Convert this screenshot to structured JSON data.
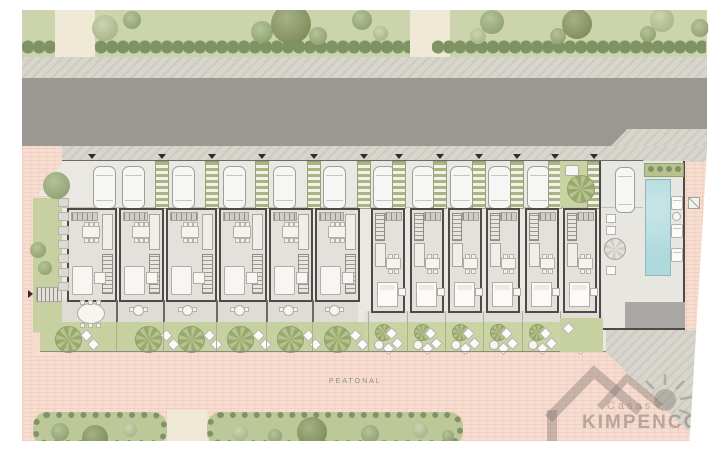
{
  "title": "Residential development site plan",
  "labels": {
    "promenade": "PEATONAL"
  },
  "watermark": {
    "line1": "Casas",
    "line2": "KIMPENCO"
  },
  "colors": {
    "park_green": "#ccd4ad",
    "hedge": "#7e9264",
    "path_cream": "#f0e9d6",
    "sidewalk": "#d8d5cd",
    "road": "#9b9892",
    "promenade_pink": "#f7dcd0",
    "site_paving": "#e9e8e3",
    "wall": "#4c4b47",
    "garden_green": "#c6d0a0",
    "pergola_stripe": "#a9b482",
    "pool_blue": "#aed9dd",
    "tree_light": "#b9c795",
    "tree_mid": "#9cb077",
    "tree_dark": "#87975c",
    "logo_gray": "rgba(128,118,111,0.45)"
  },
  "park_top": {
    "paths_x": [
      55,
      410
    ],
    "trees": [
      {
        "x": 105,
        "y": 28,
        "d": 26,
        "t": "light"
      },
      {
        "x": 132,
        "y": 20,
        "d": 18,
        "t": "mid"
      },
      {
        "x": 262,
        "y": 32,
        "d": 22,
        "t": "mid"
      },
      {
        "x": 291,
        "y": 24,
        "d": 40,
        "t": "dark"
      },
      {
        "x": 318,
        "y": 36,
        "d": 18,
        "t": "mid"
      },
      {
        "x": 362,
        "y": 20,
        "d": 20,
        "t": "mid"
      },
      {
        "x": 380,
        "y": 33,
        "d": 15,
        "t": "light"
      },
      {
        "x": 478,
        "y": 36,
        "d": 16,
        "t": "light"
      },
      {
        "x": 492,
        "y": 22,
        "d": 24,
        "t": "mid"
      },
      {
        "x": 558,
        "y": 36,
        "d": 16,
        "t": "mid"
      },
      {
        "x": 577,
        "y": 24,
        "d": 30,
        "t": "dark"
      },
      {
        "x": 648,
        "y": 34,
        "d": 16,
        "t": "mid"
      },
      {
        "x": 662,
        "y": 20,
        "d": 24,
        "t": "light"
      },
      {
        "x": 700,
        "y": 28,
        "d": 18,
        "t": "mid"
      }
    ],
    "hedge_segments": [
      {
        "x": 22,
        "w": 33
      },
      {
        "x": 95,
        "w": 315
      },
      {
        "x": 432,
        "w": 274
      }
    ]
  },
  "parking": {
    "cars_x": [
      93,
      122,
      172,
      223,
      273,
      323,
      373,
      412,
      450,
      488,
      527
    ],
    "separators_x": [
      155,
      205,
      255,
      307,
      357,
      392,
      433,
      472,
      510,
      548,
      587
    ],
    "lead_arrow_x": 88
  },
  "units": [
    {
      "id": "1",
      "type": "A",
      "x": 69,
      "w": 46,
      "tree_cx": 68,
      "big_table": true
    },
    {
      "id": "2",
      "type": "A",
      "x": 121,
      "w": 41,
      "tree_cx": 148
    },
    {
      "id": "3",
      "type": "A",
      "x": 168,
      "w": 47,
      "tree_cx": 191
    },
    {
      "id": "4",
      "type": "A",
      "x": 221,
      "w": 44,
      "tree_cx": 240
    },
    {
      "id": "5",
      "type": "A",
      "x": 271,
      "w": 40,
      "tree_cx": 290
    },
    {
      "id": "6",
      "type": "A",
      "x": 317,
      "w": 41,
      "tree_cx": 337
    },
    {
      "id": "7",
      "type": "B",
      "x": 373,
      "w": 30
    },
    {
      "id": "8",
      "type": "B",
      "x": 412,
      "w": 30
    },
    {
      "id": "9",
      "type": "B",
      "x": 450,
      "w": 30
    },
    {
      "id": "10",
      "type": "B",
      "x": 488,
      "w": 30
    },
    {
      "id": "11",
      "type": "B",
      "x": 527,
      "w": 30
    },
    {
      "id": "12",
      "type": "B",
      "x": 565,
      "w": 30
    }
  ],
  "left_garden": {
    "stones_y": [
      198,
      212,
      226,
      240,
      254,
      268,
      282
    ],
    "small_trees": [
      {
        "x": 38,
        "y": 250,
        "d": 16,
        "t": "mid"
      },
      {
        "x": 45,
        "y": 268,
        "d": 14,
        "t": "mid"
      }
    ],
    "corner_tree": {
      "x": 56,
      "y": 185,
      "d": 27,
      "t": "mid"
    }
  },
  "pool_area": {
    "loungers_y": [
      196,
      224,
      248
    ],
    "chairs_y": [
      214,
      226,
      266
    ],
    "plants": 4
  },
  "bottom_gardens": [
    {
      "x": 33,
      "w": 134,
      "bushes": [
        {
          "x": 60,
          "y": 432,
          "d": 18,
          "t": "mid"
        },
        {
          "x": 95,
          "y": 438,
          "d": 26,
          "t": "dark"
        },
        {
          "x": 130,
          "y": 430,
          "d": 14,
          "t": "light"
        }
      ]
    },
    {
      "x": 207,
      "w": 256,
      "bushes": [
        {
          "x": 240,
          "y": 433,
          "d": 16,
          "t": "light"
        },
        {
          "x": 275,
          "y": 436,
          "d": 14,
          "t": "mid"
        },
        {
          "x": 312,
          "y": 432,
          "d": 30,
          "t": "dark"
        },
        {
          "x": 370,
          "y": 434,
          "d": 18,
          "t": "mid"
        },
        {
          "x": 420,
          "y": 430,
          "d": 16,
          "t": "light"
        },
        {
          "x": 448,
          "y": 436,
          "d": 12,
          "t": "mid"
        }
      ]
    }
  ]
}
